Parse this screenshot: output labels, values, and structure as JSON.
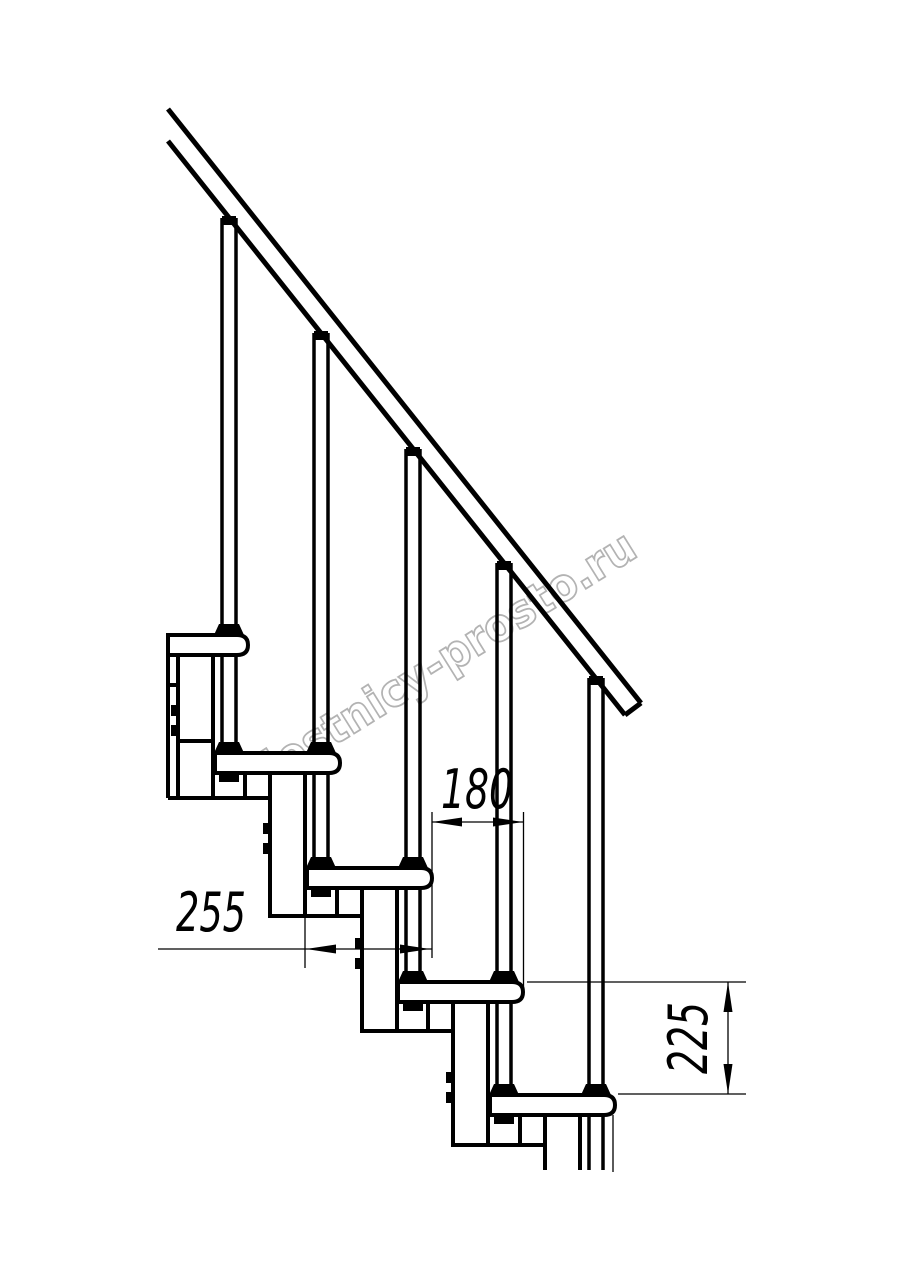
{
  "page": {
    "background_color": "#ffffff",
    "line_color": "#000000"
  },
  "watermark": {
    "text": "lestnicy-prosto.ru",
    "color": "#b3b3b3"
  },
  "dimensions": {
    "step_pitch": {
      "label": "180",
      "orientation": "horizontal"
    },
    "tread_length": {
      "label": "255",
      "orientation": "horizontal"
    },
    "step_rise": {
      "label": "225",
      "orientation": "vertical"
    }
  }
}
